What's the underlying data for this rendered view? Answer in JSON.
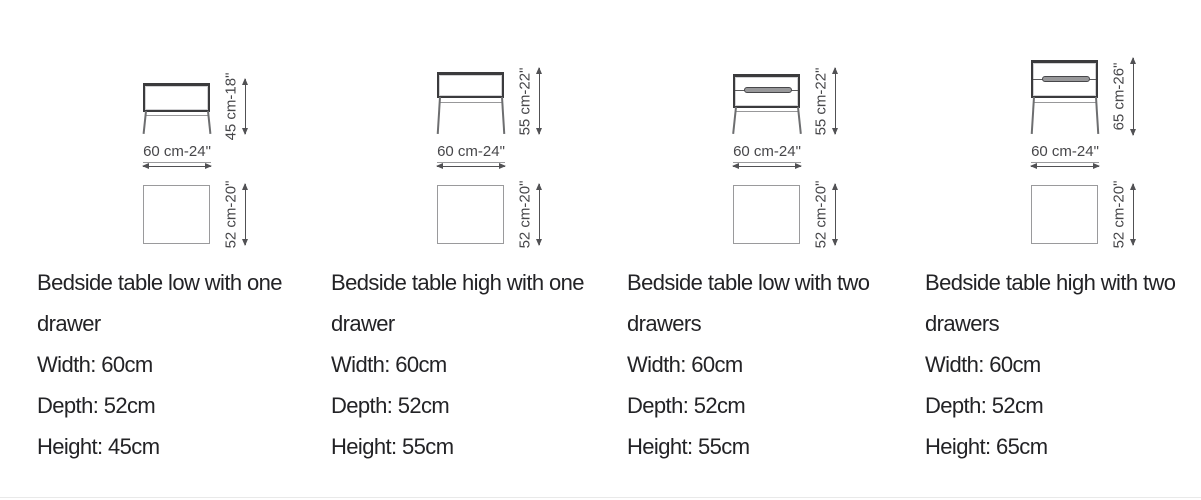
{
  "colors": {
    "background": "#ffffff",
    "body_text": "#232326",
    "dimension_text": "#47474a",
    "drawing_dark_line": "#3b3b3d",
    "drawing_light_line": "#9a9a9c",
    "arrow": "#515154"
  },
  "columns": [
    {
      "title_line1": "Bedside table low with one",
      "title_line2": "drawer",
      "width_text": "Width: 60cm",
      "depth_text": "Depth: 52cm",
      "height_text": "Height: 45cm",
      "diagram": {
        "height_label": "45 cm-18\"",
        "width_label": "60 cm-24\"",
        "depth_label": "52 cm-20\""
      }
    },
    {
      "title_line1": "Bedside table high with one",
      "title_line2": "drawer",
      "width_text": "Width: 60cm",
      "depth_text": "Depth: 52cm",
      "height_text": "Height: 55cm",
      "diagram": {
        "height_label": "55 cm-22\"",
        "width_label": "60 cm-24\"",
        "depth_label": "52 cm-20\""
      }
    },
    {
      "title_line1": "Bedside table low with two",
      "title_line2": "drawers",
      "width_text": "Width: 60cm",
      "depth_text": "Depth: 52cm",
      "height_text": "Height: 55cm",
      "diagram": {
        "height_label": "55 cm-22\"",
        "width_label": "60 cm-24\"",
        "depth_label": "52 cm-20\""
      }
    },
    {
      "title_line1": "Bedside table high with two",
      "title_line2": "drawers",
      "width_text": "Width: 60cm",
      "depth_text": "Depth: 52cm",
      "height_text": "Height: 65cm",
      "diagram": {
        "height_label": "65 cm-26\"",
        "width_label": "60 cm-24\"",
        "depth_label": "52 cm-20\""
      }
    }
  ]
}
